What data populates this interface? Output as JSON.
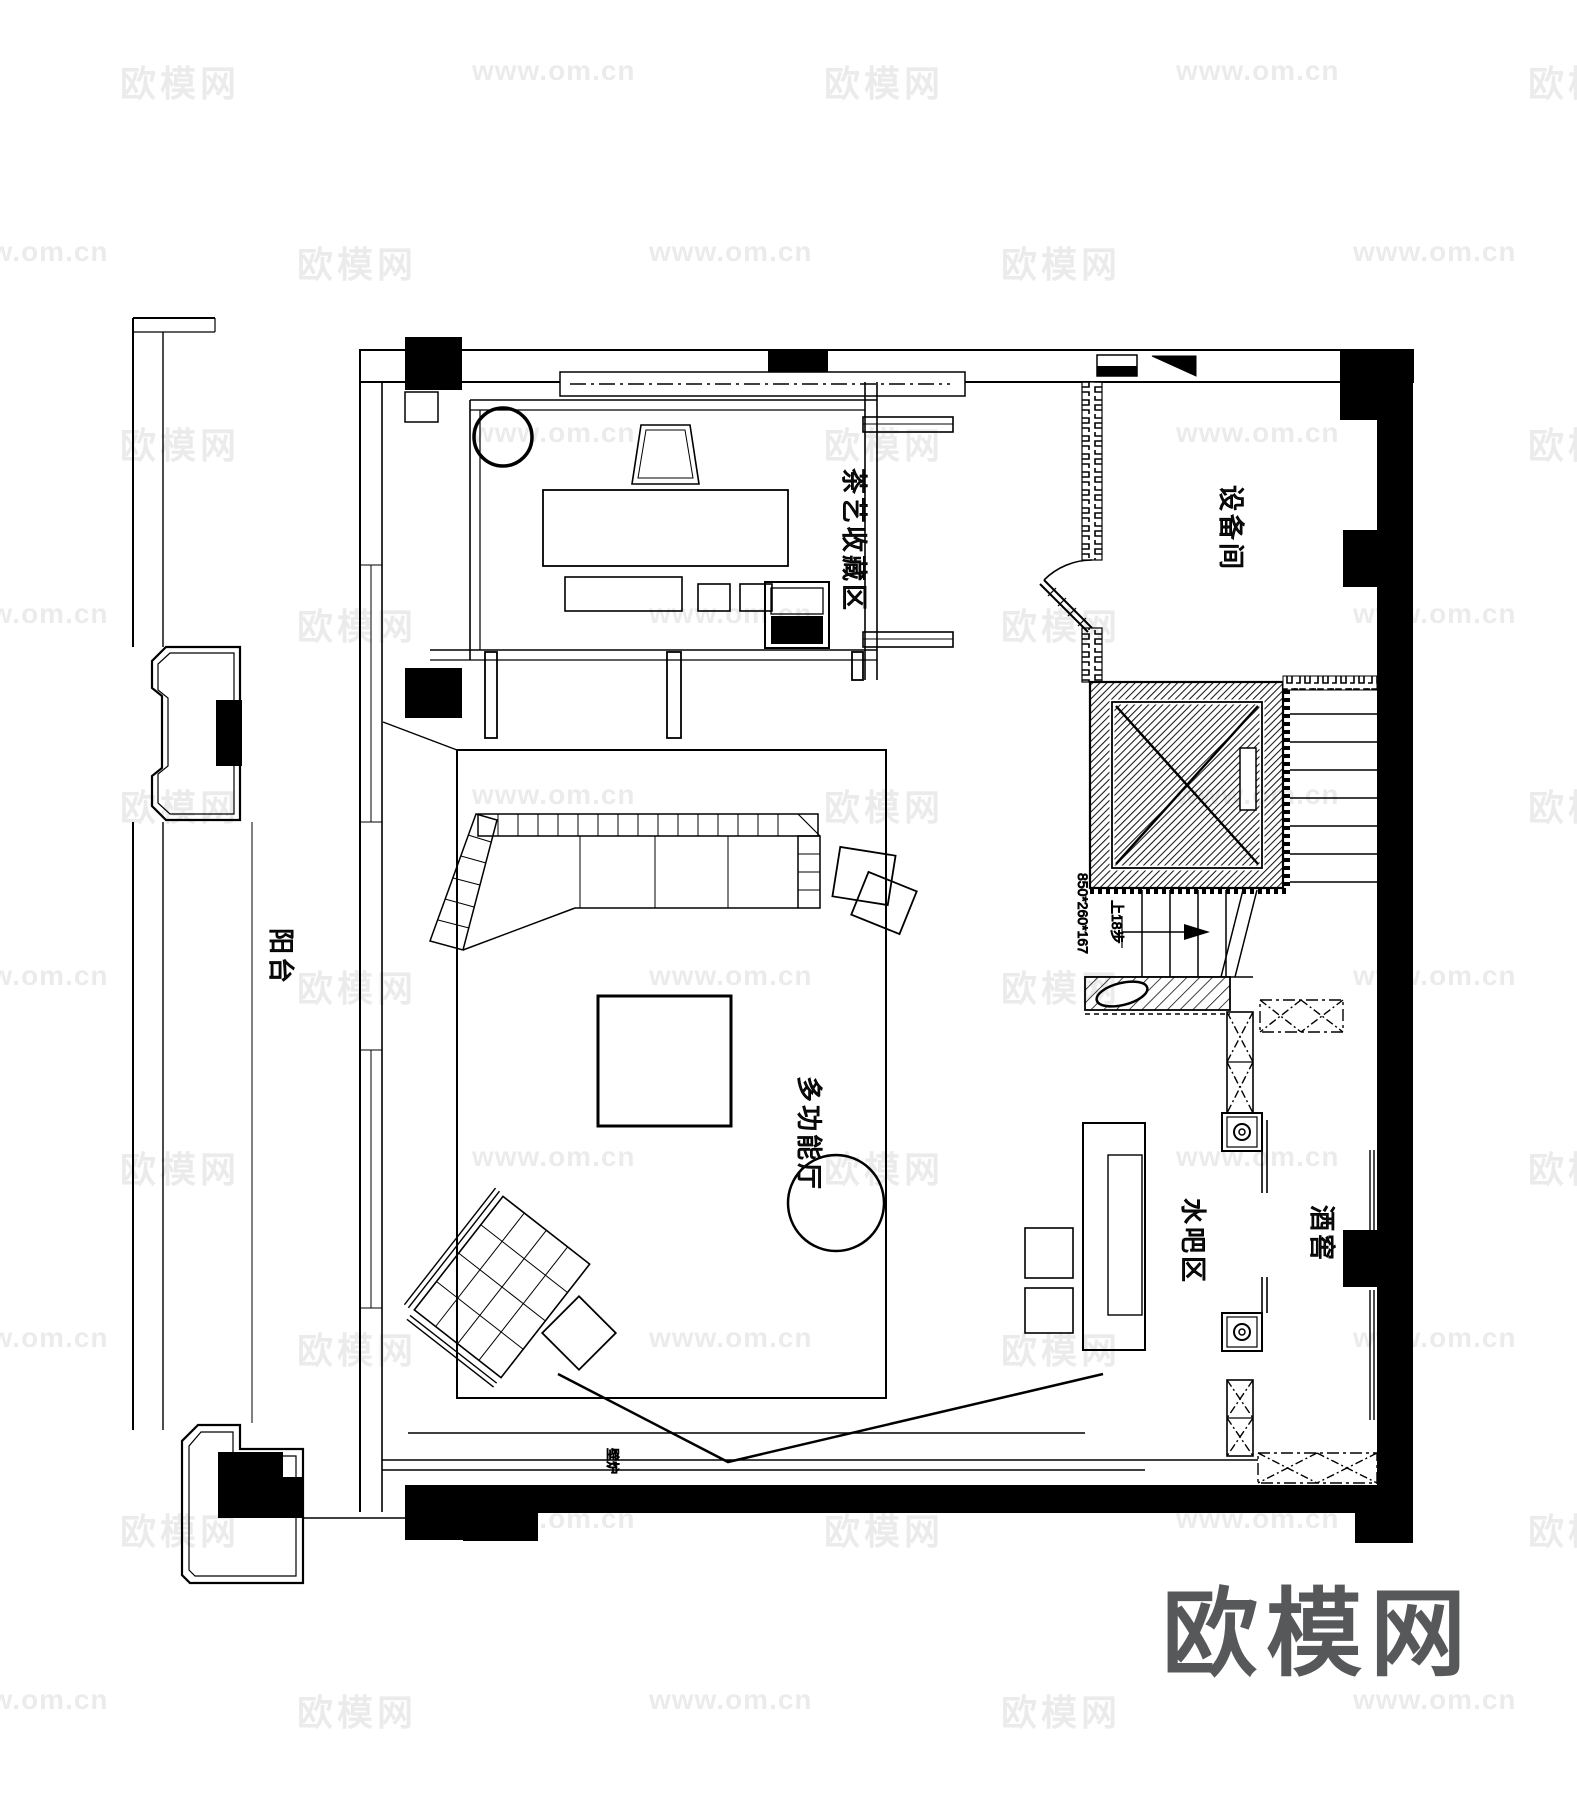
{
  "document": {
    "type": "architectural-floor-plan",
    "width_px": 1577,
    "height_px": 1800
  },
  "colors": {
    "paper": "#ffffff",
    "line": "#000000",
    "wall_fill": "#000000",
    "watermark": "rgba(0,0,0,0.08)",
    "logo_gray": "#57585a"
  },
  "rooms": {
    "tea_collection": {
      "label": "茶艺收藏区"
    },
    "equipment": {
      "label": "设备间"
    },
    "balcony": {
      "label": "阳台"
    },
    "multifunction_hall": {
      "label": "多功能厅"
    },
    "water_bar": {
      "label": "水吧区"
    },
    "wine_cellar": {
      "label": "酒窖"
    },
    "fireplace": {
      "label": "壁炉"
    }
  },
  "stairs": {
    "size_annotation": "850*260*167",
    "direction_annotation": "上18步"
  },
  "watermark": {
    "texts": [
      "欧模网",
      "www.om.cn"
    ]
  },
  "logo": {
    "text": "欧模网"
  }
}
